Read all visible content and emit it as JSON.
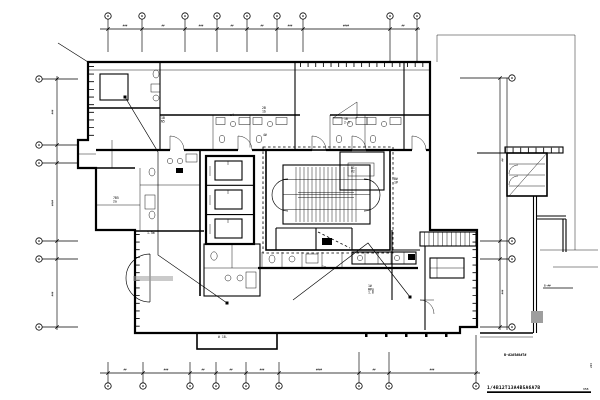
{
  "sheet": {
    "title": "1/4B12T13A4B5A6A7B",
    "title_tail": "95B",
    "wing_note": "B-#2#5#8#7#",
    "leader_note": "B-##",
    "margin_note": "2#4"
  },
  "colors": {
    "ink": "#000000",
    "paper": "#ffffff",
    "gray": "#9e9e9e"
  },
  "grid": {
    "top": {
      "bubble_y": 16,
      "dimline_y": 29,
      "dim_y": 26.5,
      "bubbles": [
        108,
        142,
        185,
        217,
        247,
        277,
        303,
        390,
        417
      ],
      "dims": [
        {
          "x": 125,
          "t": "###"
        },
        {
          "x": 163,
          "t": "##"
        },
        {
          "x": 201,
          "t": "###"
        },
        {
          "x": 232,
          "t": "##"
        },
        {
          "x": 262,
          "t": "##"
        },
        {
          "x": 290,
          "t": "###"
        },
        {
          "x": 346,
          "t": "####"
        },
        {
          "x": 403,
          "t": "##"
        }
      ]
    },
    "bottom": {
      "bubble_y": 386,
      "dimline_y": 373,
      "dim_y": 370.5,
      "bubbles": [
        108,
        143,
        190,
        216,
        246,
        279,
        359,
        389,
        476
      ],
      "dims": [
        {
          "x": 125,
          "t": "##"
        },
        {
          "x": 166,
          "t": "###"
        },
        {
          "x": 203,
          "t": "##"
        },
        {
          "x": 231,
          "t": "##"
        },
        {
          "x": 262,
          "t": "###"
        },
        {
          "x": 319,
          "t": "####"
        },
        {
          "x": 374,
          "t": "##"
        },
        {
          "x": 432,
          "t": "###"
        }
      ]
    },
    "left": {
      "bubble_x": 39,
      "dimline_x": 57,
      "dim_x": 53.5,
      "bubbles": [
        79,
        145,
        163,
        241,
        259,
        327
      ],
      "dims": [
        {
          "y": 112,
          "t": "###"
        },
        {
          "y": 203,
          "t": "####"
        },
        {
          "y": 294,
          "t": "###"
        }
      ]
    },
    "right": {
      "bubble_x": 512,
      "dimline_x": 500,
      "dim_x": 503.5,
      "bubbles": [
        78,
        241,
        259,
        327
      ],
      "dims": [
        {
          "y": 160,
          "t": "##"
        },
        {
          "y": 292,
          "t": "###"
        }
      ]
    }
  },
  "annotations": [
    {
      "x": 161,
      "y": 119,
      "lines": [
        "1B",
        "N5"
      ]
    },
    {
      "x": 230,
      "y": 116,
      "lines": [
        "a4"
      ]
    },
    {
      "x": 262,
      "y": 109,
      "lines": [
        "2B",
        "1b"
      ]
    },
    {
      "x": 344,
      "y": 120,
      "lines": [
        "1B",
        "2-6"
      ]
    },
    {
      "x": 113,
      "y": 199,
      "lines": [
        "7B5",
        "2a"
      ]
    },
    {
      "x": 263,
      "y": 136,
      "lines": [
        "4#"
      ]
    },
    {
      "x": 351,
      "y": 169,
      "lines": [
        "B1",
        "#2"
      ]
    },
    {
      "x": 394,
      "y": 180,
      "lines": [
        "B#",
        "1#"
      ]
    },
    {
      "x": 322,
      "y": 268,
      "lines": [
        "1g"
      ]
    },
    {
      "x": 368,
      "y": 287,
      "lines": [
        "1#",
        "W#g",
        "1.8"
      ]
    },
    {
      "x": 218,
      "y": 338,
      "lines": [
        "# 18."
      ]
    },
    {
      "x": 147,
      "y": 234,
      "lines": [
        "1.5m"
      ]
    }
  ]
}
